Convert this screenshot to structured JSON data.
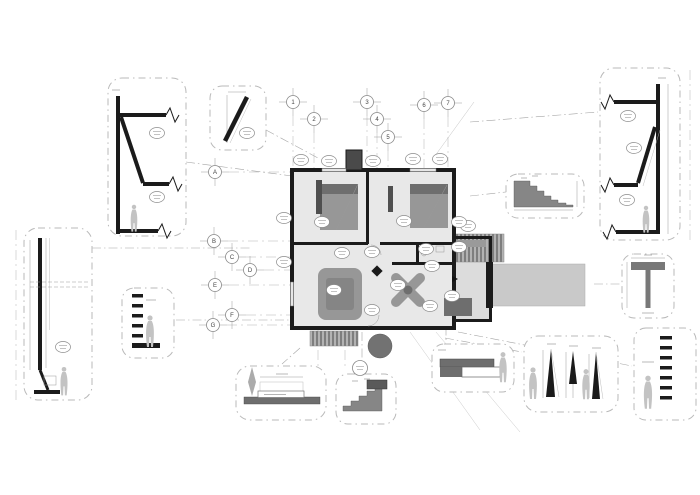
{
  "grid": {
    "columns": [
      "1",
      "2",
      "3",
      "4",
      "5",
      "6",
      "7"
    ],
    "rows": [
      "A",
      "B",
      "C",
      "D",
      "E",
      "F",
      "G"
    ]
  },
  "colors": {
    "paper": "#ffffff",
    "line": "#a6a6a6",
    "panelBorder": "#b9b9b9",
    "wall": "#1b1b1b",
    "floor": "#e8e8e8",
    "floorAlt": "#dcdcdc",
    "furniture": "#979797",
    "furnDark": "#6e6e6e",
    "stair": "#868686",
    "terrace": "#c9c9c9",
    "figure": "#c3c3c3"
  }
}
